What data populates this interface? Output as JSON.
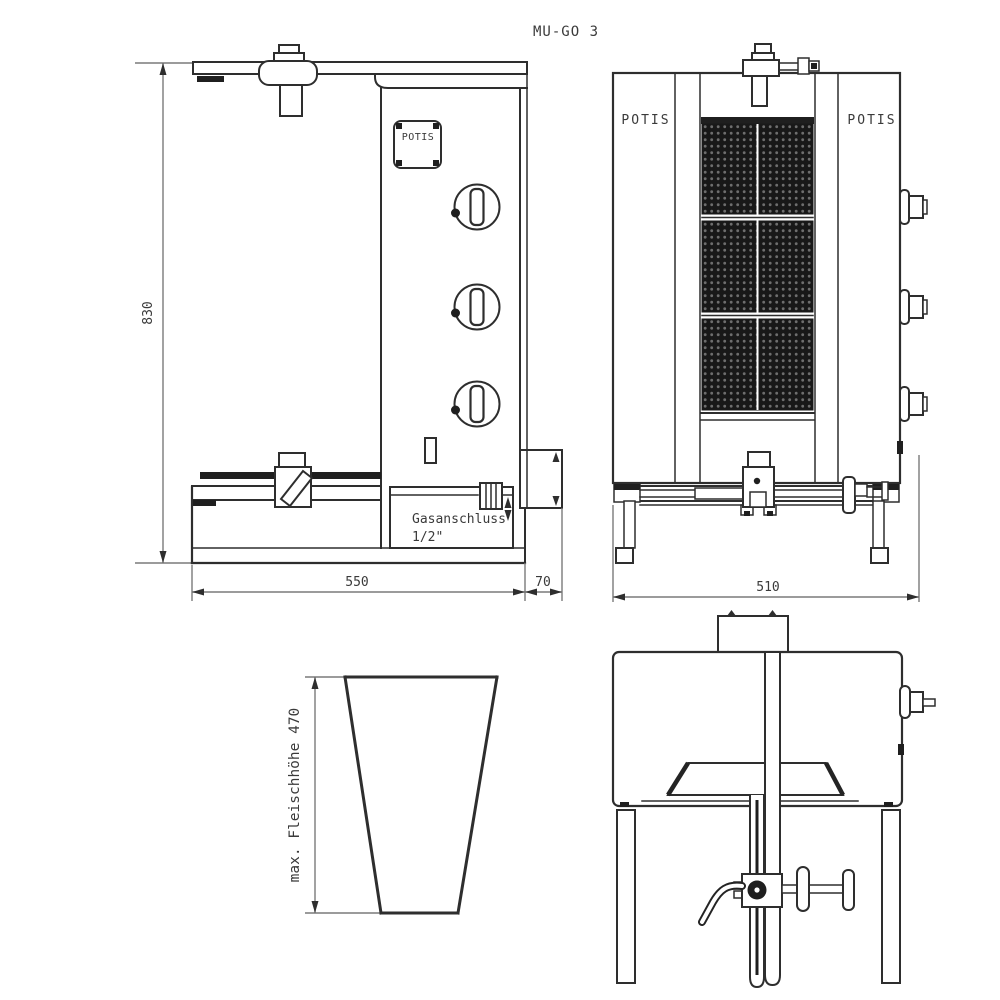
{
  "page": {
    "background": "#ffffff",
    "title": "MU-GO 3"
  },
  "drawing": {
    "brand": "POTIS",
    "colors": {
      "object_line": "#2e2e2e",
      "dimension_line": "#7a7a7a",
      "burner_fill": "#181818",
      "text": "#3a3a3a",
      "background": "#ffffff"
    },
    "side_view": {
      "logo": "POTIS",
      "dim_height": "830",
      "dim_width": "550",
      "dim_gas_offset": "70",
      "gas_line1": "Gasanschluss",
      "gas_line2": "1/2\"",
      "knob_count": "3"
    },
    "front_view": {
      "label_left": "POTIS",
      "label_right": "POTIS",
      "dim_width": "510",
      "burner_sections": "3"
    },
    "meat_cone": {
      "label": "max. Fleischhöhe 470"
    }
  }
}
